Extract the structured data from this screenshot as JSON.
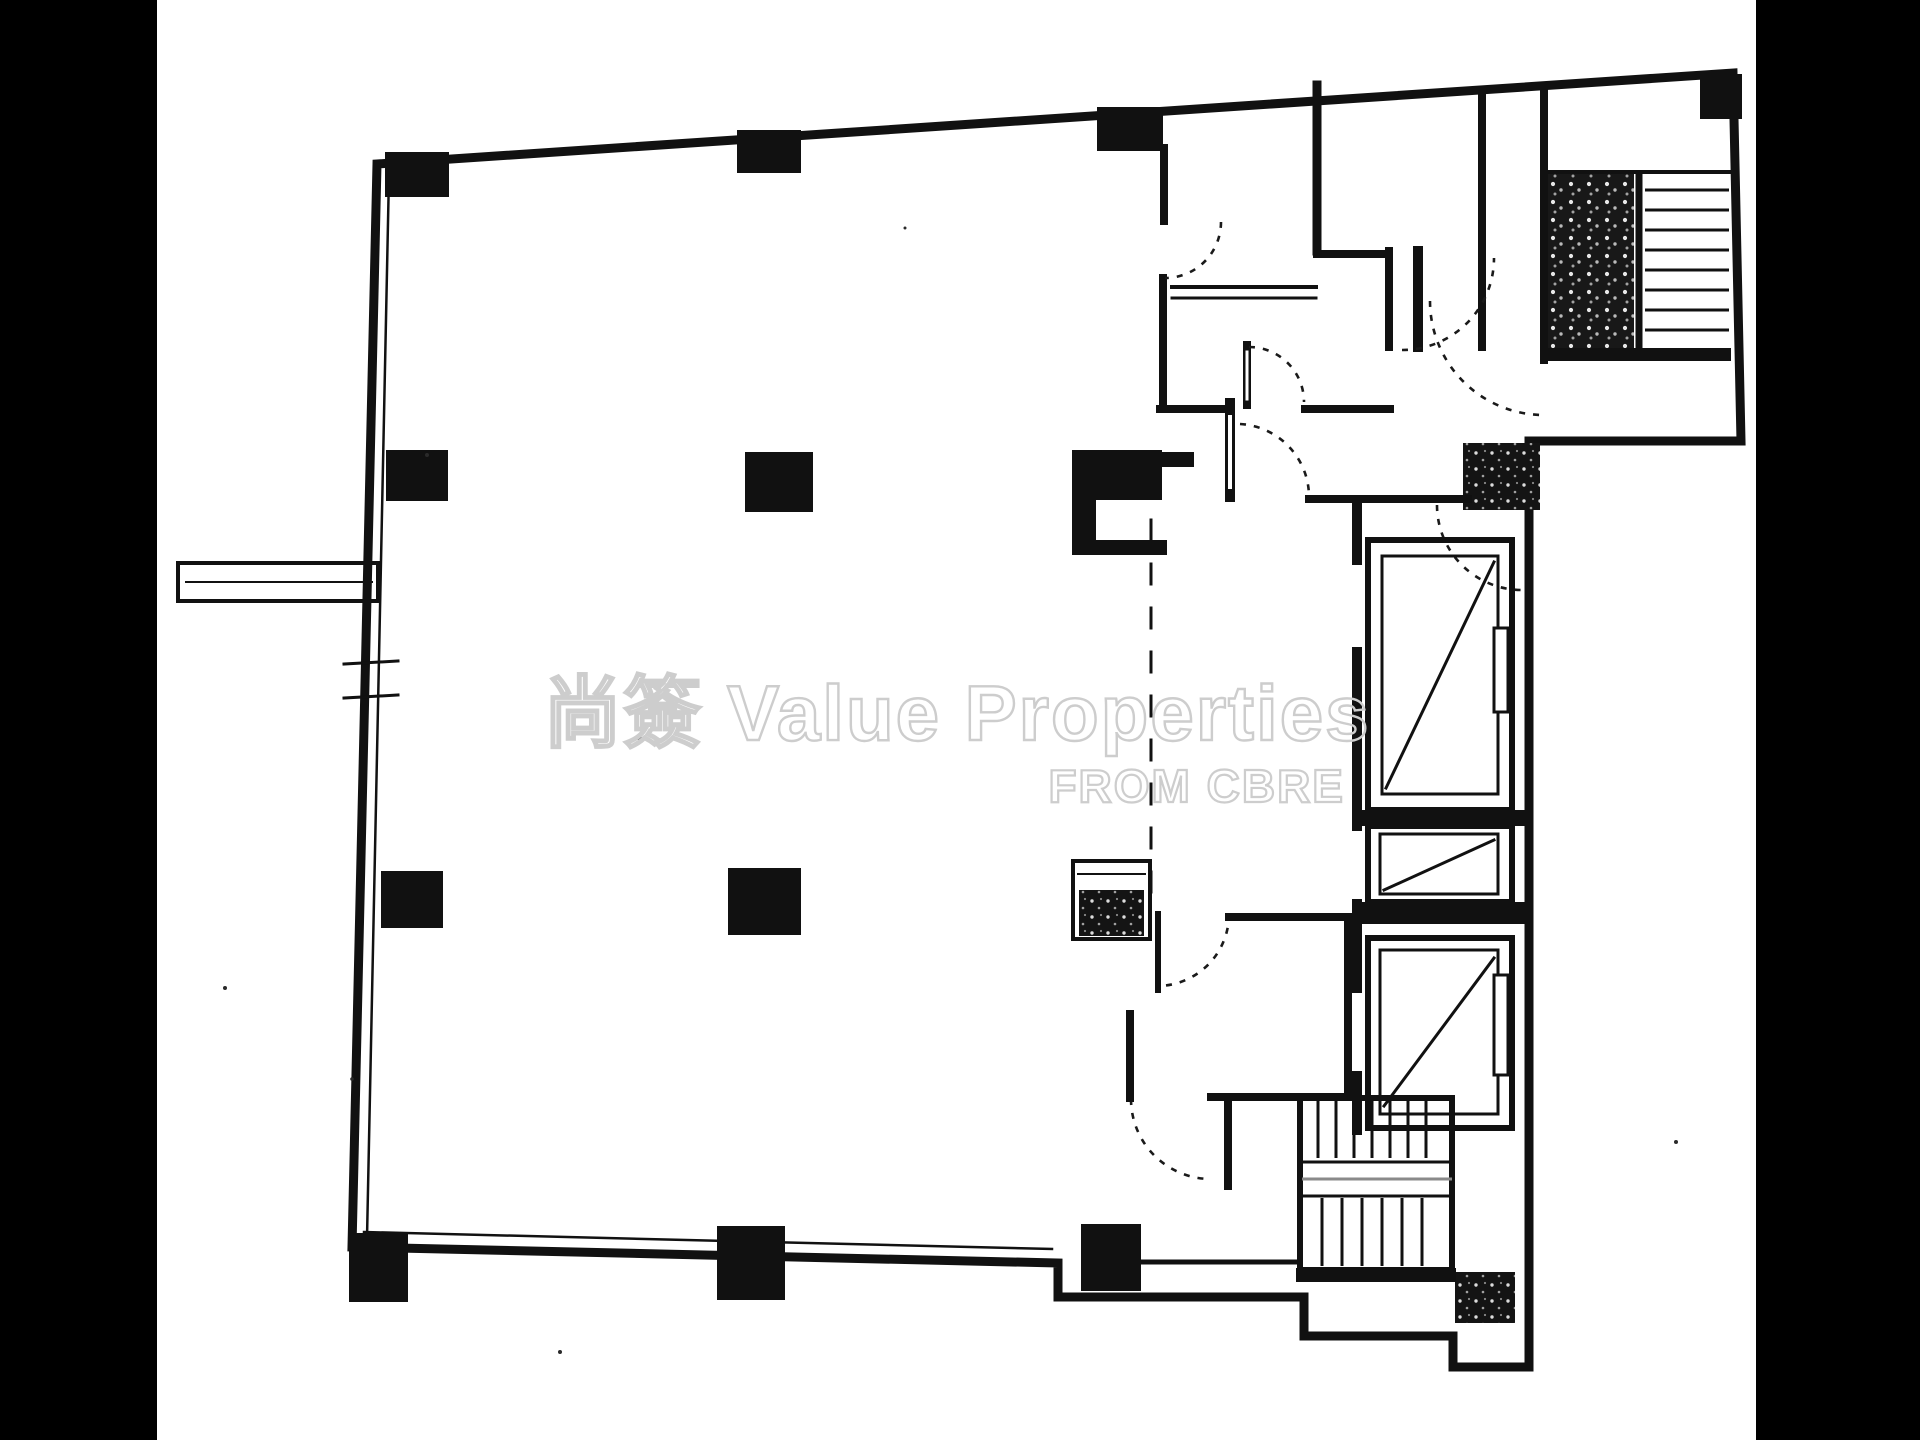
{
  "watermark": {
    "brand": "尚簽 Value Properties",
    "subtitle": "FROM CBRE"
  },
  "colors": {
    "background": "#ffffff",
    "scan_bar": "#000000",
    "wall_line": "#111111",
    "watermark_gray": "#cdcdcd"
  }
}
